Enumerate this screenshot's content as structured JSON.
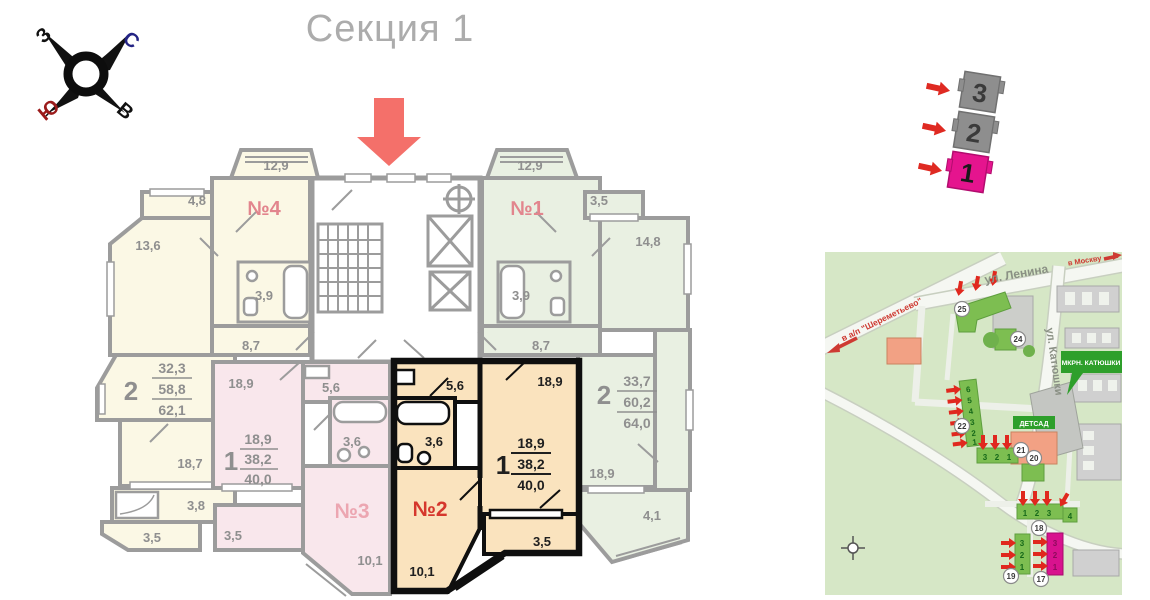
{
  "title": "Секция 1",
  "compass": {
    "n": "С",
    "s": "Ю",
    "w": "З",
    "e": "В"
  },
  "plan": {
    "apt4": {
      "label": "№4",
      "bay": "12,9",
      "closet": "4,8",
      "room": "13,6",
      "bath": "3,9",
      "hall": "8,7"
    },
    "apt1": {
      "label": "№1",
      "bay": "12,9",
      "closet": "3,5",
      "room": "14,8",
      "bath": "3,9",
      "hall": "8,7"
    },
    "left2": {
      "rooms": "2",
      "living": "32,3",
      "total": "58,8",
      "total_full": "62,1",
      "room1": "18,7",
      "bath": "3,8",
      "balcony": "3,5"
    },
    "right2": {
      "rooms": "2",
      "living": "33,7",
      "total": "60,2",
      "total_full": "64,0",
      "room1": "18,9",
      "balcony": "4,1"
    },
    "apt3": {
      "label": "№3",
      "room": "18,9",
      "hall": "5,6",
      "bath": "3,6",
      "rooms": "1",
      "living": "18,9",
      "total": "38,2",
      "total_full": "40,0",
      "kitchen": "10,1",
      "balcony": "3,5"
    },
    "apt2": {
      "label": "№2",
      "room": "18,9",
      "hall": "5,6",
      "bath": "3,6",
      "rooms": "1",
      "living": "18,9",
      "total": "38,2",
      "total_full": "40,0",
      "kitchen": "10,1",
      "balcony": "3,5"
    }
  },
  "stack": {
    "floors": [
      "3",
      "2",
      "1"
    ]
  },
  "map": {
    "street_lenina": "ул. Ленина",
    "street_katyushki": "ул. Катюшки",
    "dir_sheremetyevo": "в а/п \"Шереметьево\"",
    "dir_moscow": "в Москву",
    "district": "МКРН. КАТЮШКИ",
    "kindergarten": "ДЕТСАД",
    "b17": "17",
    "b18": "18",
    "b19": "19",
    "b20": "20",
    "b21": "21",
    "b22": "22",
    "b24": "24",
    "b25": "25",
    "b22_sections": [
      "6",
      "5",
      "4",
      "3",
      "2",
      "1"
    ],
    "b21_sections": [
      "3",
      "2",
      "1"
    ],
    "b18_sections": [
      "1",
      "2",
      "3",
      "4"
    ],
    "b19_sections": [
      "3",
      "2",
      "1"
    ],
    "b17_sections": [
      "3",
      "2",
      "1"
    ]
  },
  "colors": {
    "accent_magenta": "#E5148E",
    "arrow_red": "#F4706A",
    "map_red": "#E0281E"
  }
}
